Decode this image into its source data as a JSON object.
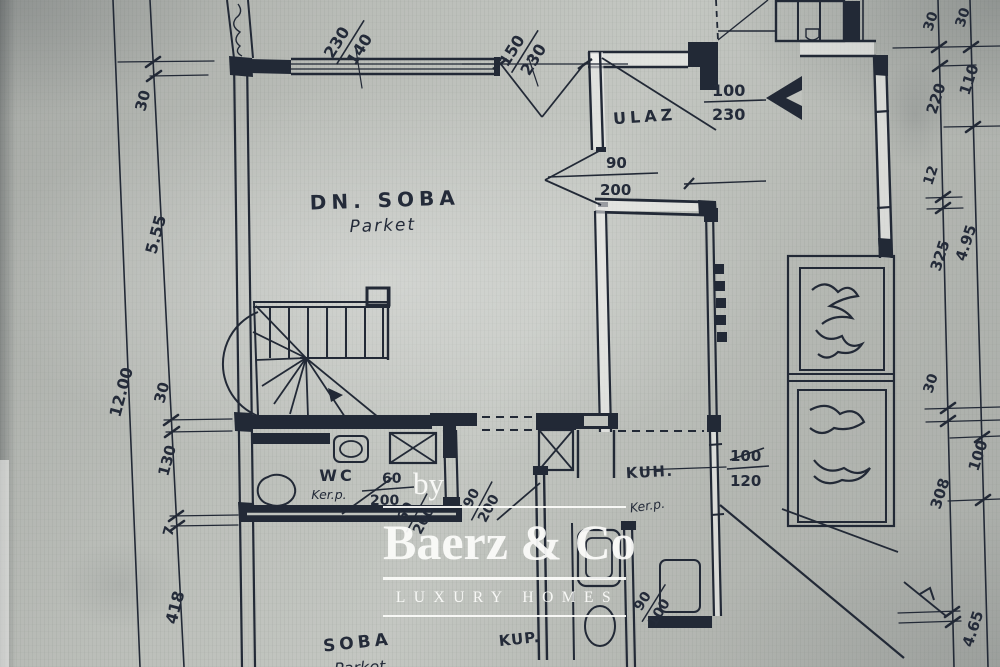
{
  "colors": {
    "paper": "#b9bcb7",
    "ink": "#222936",
    "watermark": "#ffffff"
  },
  "watermark": {
    "by": "by",
    "brand": "Baerz & Co",
    "tagline": "LUXURY HOMES"
  },
  "rooms": {
    "dn_soba": {
      "name": "DN. SOBA",
      "floor": "Parket"
    },
    "ulaz": {
      "name": "ULAZ"
    },
    "wc": {
      "name": "WC",
      "floor": "Ker.p."
    },
    "kuh": {
      "name": "KUH.",
      "floor": "Ker.p."
    },
    "soba": {
      "name": "SOBA",
      "floor": "Parket"
    },
    "kup": {
      "name": "KUP."
    }
  },
  "openings": {
    "win_top": {
      "w": "230",
      "h": "140"
    },
    "door_top": {
      "w": "150",
      "h": "230"
    },
    "door_entry": {
      "w": "100",
      "h": "230"
    },
    "door_dnsoba": {
      "w": "90",
      "h": "200"
    },
    "door_wc": {
      "w": "60",
      "h": "200"
    },
    "door_corridor_a": {
      "w": "60",
      "h": "200"
    },
    "door_corridor_b": {
      "w": "90",
      "h": "200"
    },
    "win_kuh": {
      "w": "100",
      "h": "120"
    },
    "win_kup": {
      "w": "90",
      "h": "100"
    }
  },
  "dims": {
    "left_outer": "12.00",
    "left_chain": [
      "30",
      "5.55",
      "30",
      "130",
      "7",
      "418"
    ],
    "right_inner": [
      "30",
      "220",
      "12",
      "325",
      "30",
      "308"
    ],
    "right_outer": [
      "30",
      "110",
      "4.95",
      "100",
      "4.65"
    ]
  }
}
